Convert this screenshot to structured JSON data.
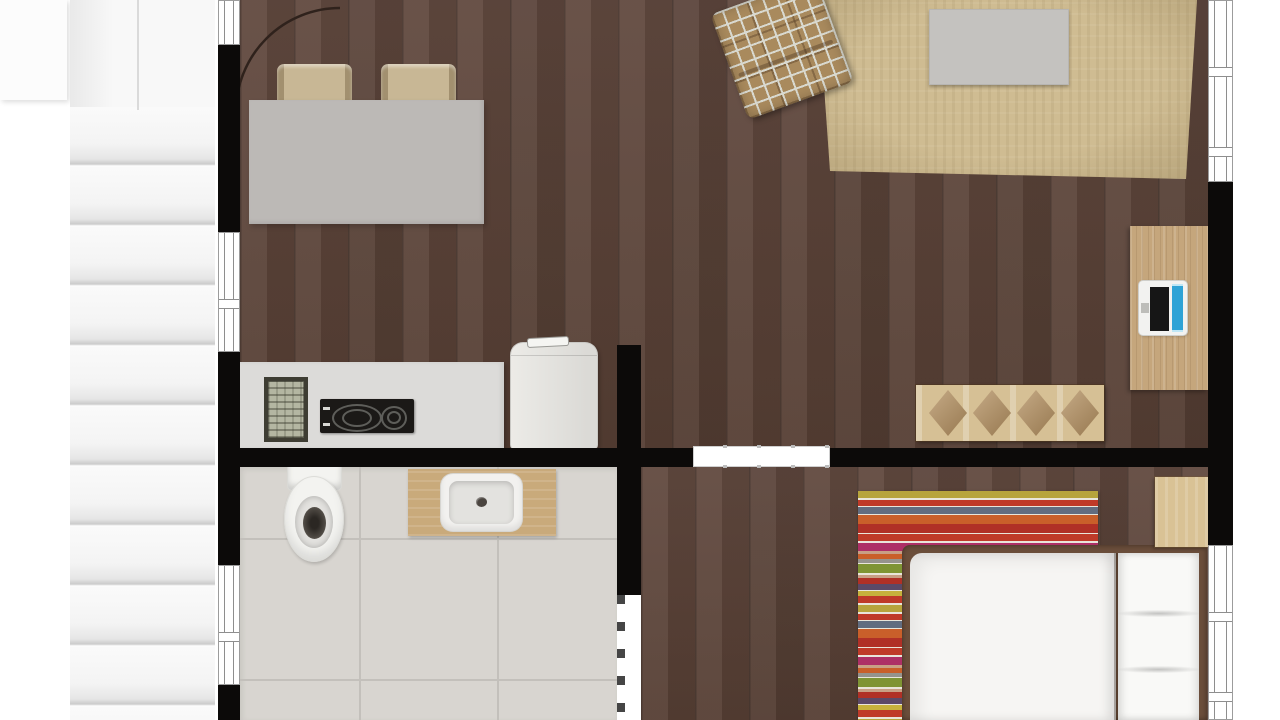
{
  "meta": {
    "description": "3D rendered apartment floor plan, top-down view, no visible text",
    "visible_text": []
  },
  "palette": {
    "wall": "#0c0a09",
    "wood": "#5b4237",
    "stair": "#f6f6f6",
    "step_line": "#c7c7c7",
    "tile": "#d8d5d0",
    "grout": "#c3c0bb",
    "counter": "#dcdbd9",
    "appliance_black": "#1b1917",
    "fridge": "#e7e6e2",
    "table": "#bcb9b6",
    "chair": "#c8b795",
    "rug_living": "#cfbc92",
    "rug_edge": "#b5a47d",
    "plaid": "#a98a5d",
    "plaid_line": "#d9d9cf",
    "desk": "#c5a67c",
    "sideboard": "#d6c095",
    "diamond": "#b28e5e",
    "laptop_blue": "#2fa3d6",
    "porcelain": "#f3f3f0",
    "basin": "#e3e2df",
    "drain": "#4a443f",
    "vanity": "#c9aa7b",
    "bed_frame": "#6b4e3b",
    "linen": "#f6f5f3",
    "nightstand": "#d9c295",
    "r_red": "#bf3a28",
    "r_orange": "#c95f2a",
    "r_yellow": "#b7a43c",
    "r_slate": "#626d80",
    "r_magenta": "#ad2f66",
    "r_green": "#7f9434",
    "r_purple": "#5b4967",
    "r_white": "#e9e5da",
    "r_tan": "#c89f85",
    "r_gray": "#96938d"
  },
  "objects": {
    "stairwell": {
      "visible_steps": 11,
      "landing": true
    },
    "dining_area": [
      "dining-table",
      "chair x2",
      "door-swing-arc"
    ],
    "living_area": [
      "area-rug",
      "coffee-table",
      "plaid-armchair",
      "diamond-sideboard"
    ],
    "office_nook": [
      "desk",
      "laptop"
    ],
    "kitchen": [
      "counter",
      "dish-rack",
      "two-burner-cooktop",
      "refrigerator"
    ],
    "bathroom": [
      "toilet",
      "wood-vanity",
      "sink"
    ],
    "bedroom": [
      "striped-rug",
      "double-bed",
      "pillows x2",
      "nightstand"
    ],
    "openings": [
      "left-wall-windows x3",
      "right-wall-windows x2",
      "sliding-door",
      "bathroom-door-opening"
    ]
  }
}
